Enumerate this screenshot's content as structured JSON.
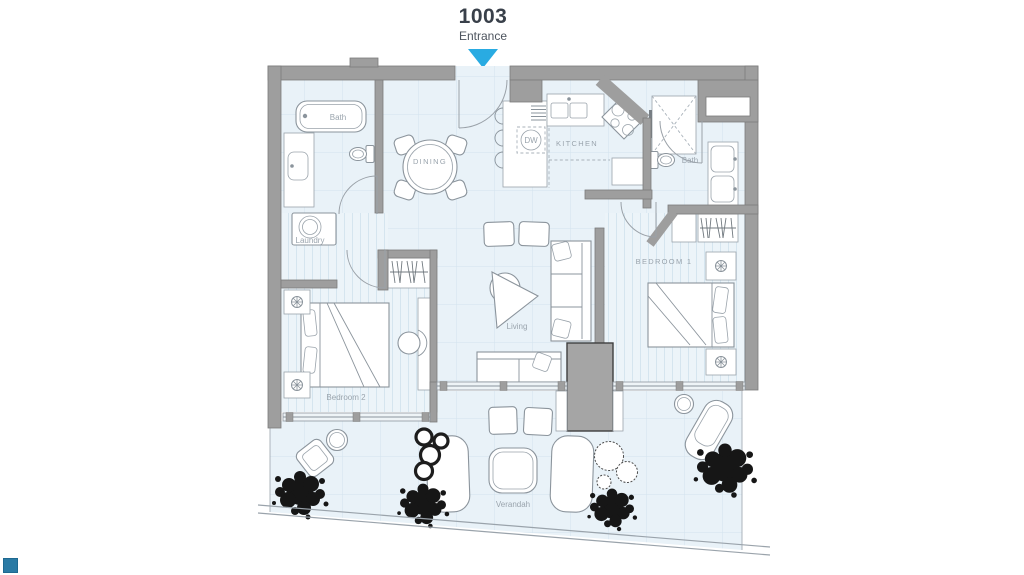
{
  "unit": {
    "number": "1003",
    "entrance_label": "Entrance"
  },
  "rooms": {
    "bath1": "Bath",
    "dining": "DINING",
    "kitchen": "KITCHEN",
    "dishwasher": "DW",
    "bath2": "Bath",
    "bedroom1": "BEDROOM 1",
    "laundry": "Laundry",
    "living": "Living",
    "bedroom2": "Bedroom 2",
    "verandah": "Verandah"
  },
  "colors": {
    "accent": "#29abe2",
    "wall": "#9e9e9e",
    "floor": "#e9f2f8",
    "marker": "#2a7aa4"
  }
}
